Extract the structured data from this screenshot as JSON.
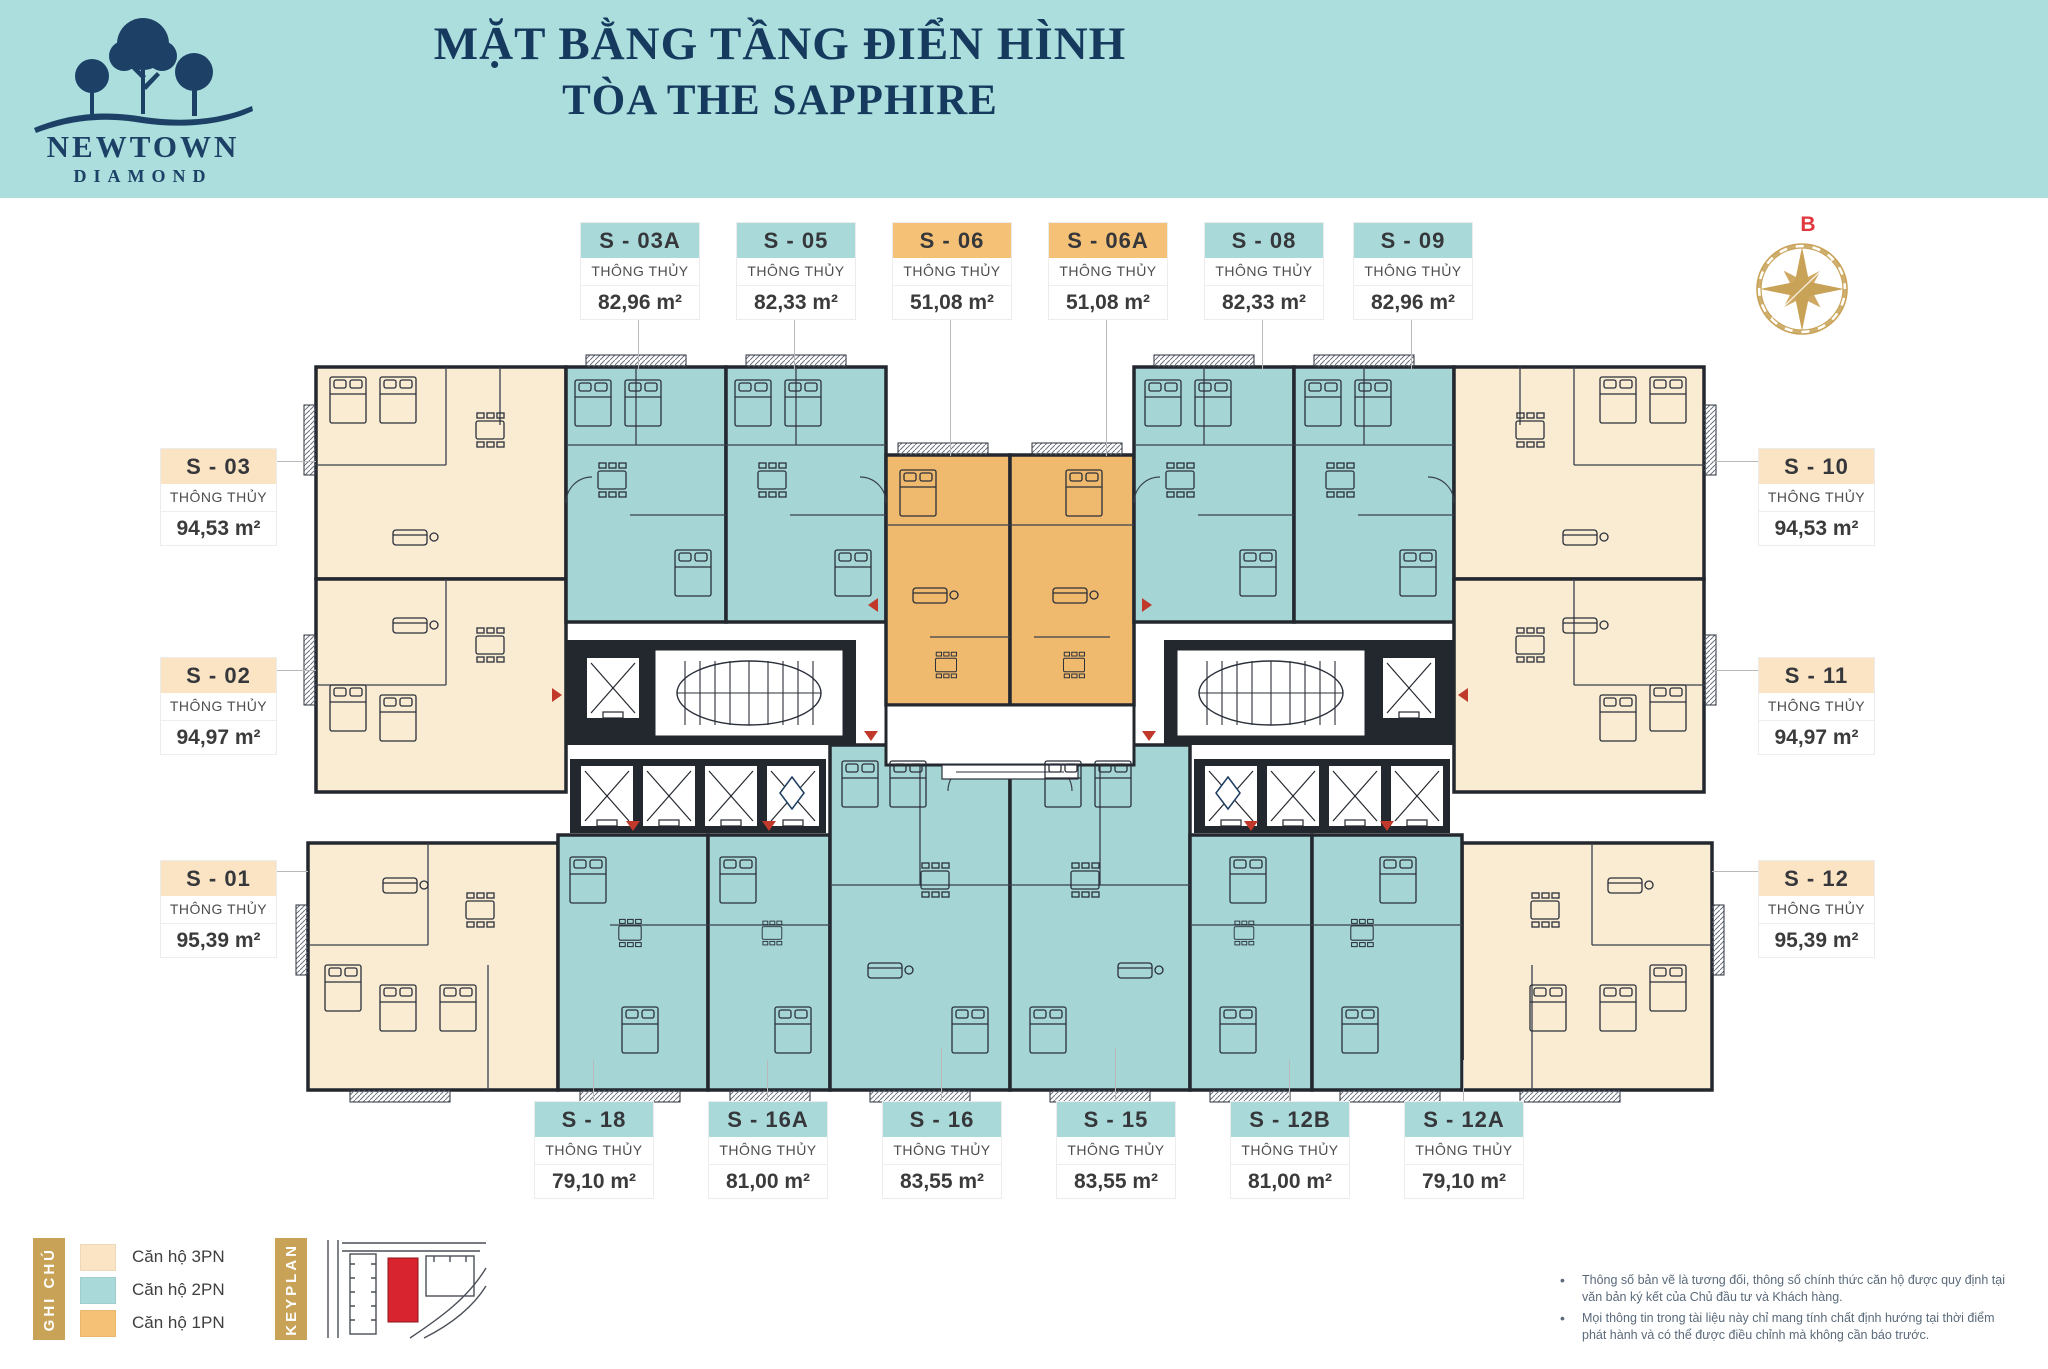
{
  "brand": {
    "name": "NEWTOWN",
    "sub": "DIAMOND"
  },
  "header": {
    "title_line1": "MẶT BẰNG TẦNG ĐIỂN HÌNH",
    "title_line2": "TÒA THE SAPPHIRE"
  },
  "compass": {
    "label": "B"
  },
  "labels": {
    "spec": "THÔNG THỦY"
  },
  "units": {
    "top": [
      {
        "id": "S - 03A",
        "area": "82,96 m²",
        "type": "2PN"
      },
      {
        "id": "S - 05",
        "area": "82,33 m²",
        "type": "2PN"
      },
      {
        "id": "S - 06",
        "area": "51,08 m²",
        "type": "1PN"
      },
      {
        "id": "S - 06A",
        "area": "51,08 m²",
        "type": "1PN"
      },
      {
        "id": "S - 08",
        "area": "82,33 m²",
        "type": "2PN"
      },
      {
        "id": "S - 09",
        "area": "82,96 m²",
        "type": "2PN"
      }
    ],
    "left": [
      {
        "id": "S - 03",
        "area": "94,53 m²",
        "type": "3PN"
      },
      {
        "id": "S - 02",
        "area": "94,97 m²",
        "type": "3PN"
      },
      {
        "id": "S - 01",
        "area": "95,39 m²",
        "type": "3PN"
      }
    ],
    "right": [
      {
        "id": "S - 10",
        "area": "94,53 m²",
        "type": "3PN"
      },
      {
        "id": "S - 11",
        "area": "94,97 m²",
        "type": "3PN"
      },
      {
        "id": "S - 12",
        "area": "95,39 m²",
        "type": "3PN"
      }
    ],
    "bottom": [
      {
        "id": "S - 18",
        "area": "79,10 m²",
        "type": "2PN"
      },
      {
        "id": "S - 16A",
        "area": "81,00 m²",
        "type": "2PN"
      },
      {
        "id": "S - 16",
        "area": "83,55 m²",
        "type": "2PN"
      },
      {
        "id": "S - 15",
        "area": "83,55 m²",
        "type": "2PN"
      },
      {
        "id": "S - 12B",
        "area": "81,00 m²",
        "type": "2PN"
      },
      {
        "id": "S - 12A",
        "area": "79,10 m²",
        "type": "2PN"
      }
    ]
  },
  "legend": {
    "title": "GHI CHÚ",
    "keyplan_title": "KEYPLAN",
    "items": [
      {
        "label": "Căn hộ 3PN",
        "color": "#fbe4c4"
      },
      {
        "label": "Căn hộ 2PN",
        "color": "#a9d9d8"
      },
      {
        "label": "Căn hộ 1PN",
        "color": "#f5c176"
      }
    ]
  },
  "disclaimer": [
    "Thông số bản vẽ là tương đối, thông số chính thức căn hộ được quy định tại văn bản ký kết của Chủ đầu tư và Khách hàng.",
    "Mọi thông tin trong tài liệu này chỉ mang tính chất định hướng tại thời điểm phát hành và có thể được điều chỉnh mà không cần báo trước."
  ],
  "colors": {
    "band": "#abdedd",
    "navy": "#16395e",
    "gold": "#c8a257",
    "cream_fill": "#f9ecd3",
    "teal_fill": "#a5d6d5",
    "orange_fill": "#f0ba6e",
    "cream_header": "#fbe4c4",
    "teal_header": "#a9d9d8",
    "orange_header": "#f5c176",
    "wall": "#23272e",
    "keyplan_highlight": "#d8242e",
    "compass_label": "#e2373f"
  }
}
